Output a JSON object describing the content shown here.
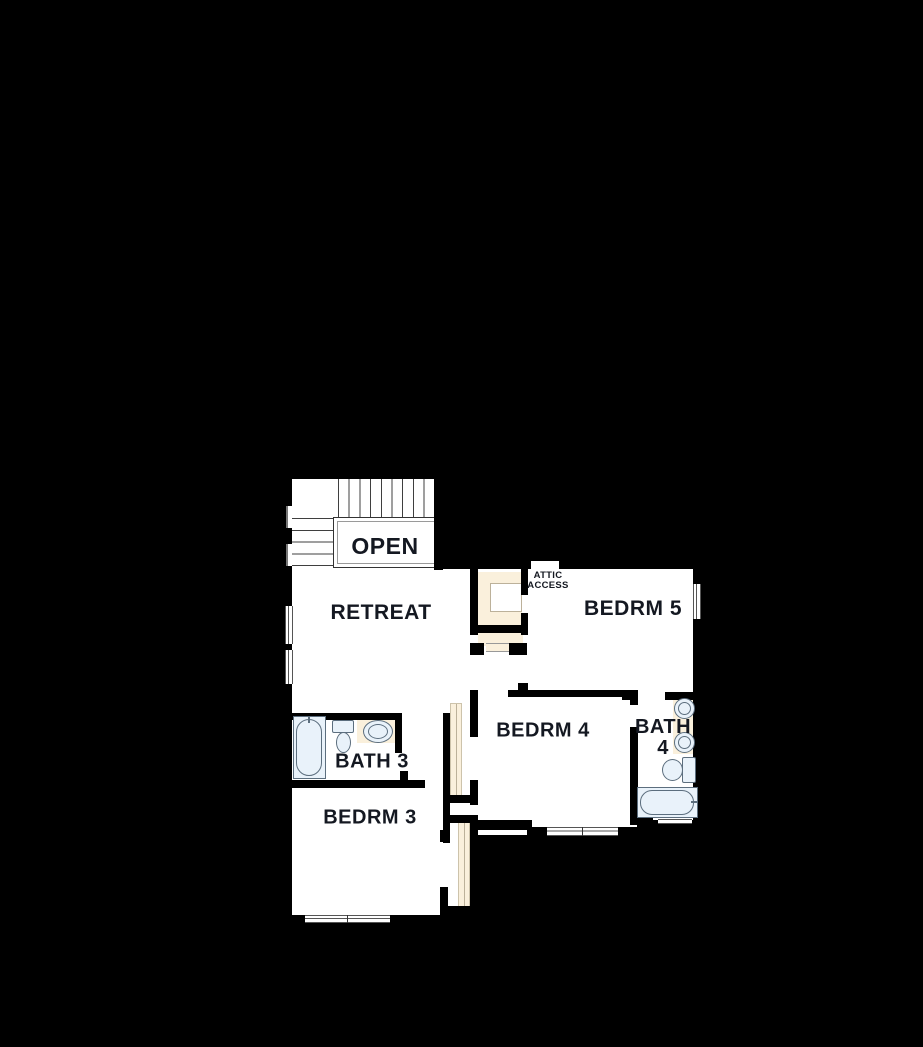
{
  "plan_title": "second floor plan",
  "palette": {
    "bg": "#000000",
    "wall": "#000000",
    "floor": "#ffffff",
    "closet": "#faf0dc",
    "fixture": "#e9f2fa",
    "fixline": "#5c6e7e",
    "stair": "#3f3f3f",
    "winline": "#555555",
    "shelfline": "#bcb19a",
    "text": "#141821"
  },
  "rooms": {
    "open": {
      "label": "OPEN"
    },
    "retreat": {
      "label": "RETREAT"
    },
    "attic_access": {
      "line1": "ATTIC",
      "line2": "ACCESS"
    },
    "bedrm5": {
      "label": "BEDRM 5"
    },
    "bedrm4": {
      "label": "BEDRM 4"
    },
    "bath3": {
      "label": "BATH 3"
    },
    "bath4": {
      "line1": "BATH",
      "line2": "4"
    },
    "bedrm3": {
      "label": "BEDRM 3"
    }
  },
  "fixtures": {
    "bath3": [
      "bathtub",
      "toilet",
      "sink-vanity"
    ],
    "bath4": [
      "double-sink-vanity",
      "toilet",
      "bathtub"
    ],
    "features": [
      "staircase",
      "windows",
      "closet-shelving",
      "attic-access-opening"
    ]
  }
}
